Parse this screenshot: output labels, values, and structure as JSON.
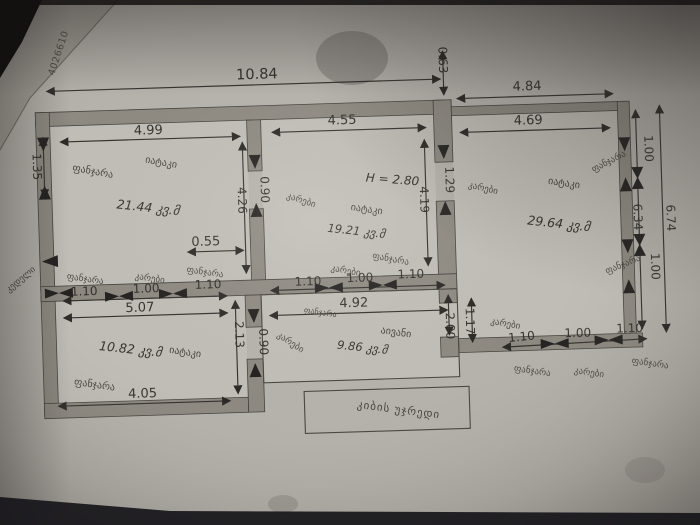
{
  "photo": {
    "serial_number": "4026610"
  },
  "words": {
    "window": "ფანჯარა",
    "door": "კარები",
    "wall": "კედელი"
  },
  "overall": {
    "total_width": "10.84",
    "top_offset": "0.63"
  },
  "room1": {
    "label": "იატაკი",
    "area": "21.44 კვ.მ",
    "width": "4.99",
    "window_left": "1.35",
    "depth": "4.26",
    "door_to_room2": "0.90",
    "window_offset": "0.55"
  },
  "room2": {
    "label": "იატაკი",
    "area": "19.21 კვ.მ",
    "width": "4.55",
    "depth": "4.19",
    "ceiling_height": "H = 2.80",
    "door_to_room3": "1.29"
  },
  "room3": {
    "label": "იატაკი",
    "area": "29.64 კვ.მ",
    "width_outer": "4.84",
    "width_inner": "4.69",
    "window_top": "1.00",
    "side_inner": "6.34",
    "side_outer": "6.74",
    "window_bottom": "1.00",
    "seg_left": "1.10",
    "seg_mid": "1.00",
    "seg_right": "1.10"
  },
  "room4": {
    "label": "იატაკი",
    "area": "10.82 კვ.მ",
    "top_width": "5.07",
    "seg_left": "1.10",
    "seg_mid": "1.00",
    "seg_right": "1.10",
    "depth": "2.13",
    "bottom_width": "4.05"
  },
  "balcony": {
    "label": "აივანი",
    "area": "9.86 კვ.მ",
    "width": "4.92",
    "door_left": "0.90",
    "depth": "2.00",
    "door_right": "1.17"
  },
  "stairwell": {
    "label": "კიბის უჯრედი"
  }
}
